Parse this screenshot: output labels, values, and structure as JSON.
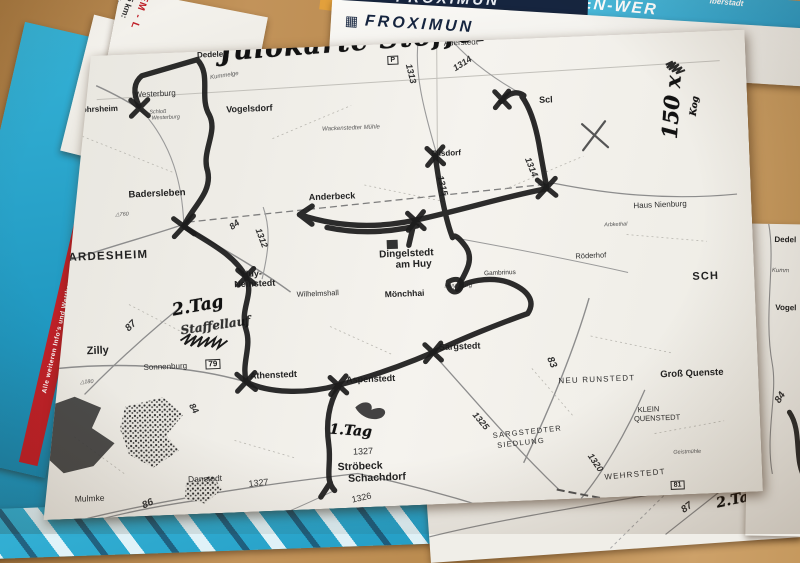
{
  "handwriting": {
    "title": "Julokarte Stoffel",
    "day2": "2.Tag",
    "day2_scribble": "Staffellauf",
    "day1": "1.Tag",
    "copies": "150 x",
    "copies_note": "Kog",
    "day2_bottom": "2.Tag"
  },
  "map": {
    "labels": {
      "dedeleben": "Dedeleb",
      "p_symbol": "P",
      "r78": "78",
      "westerburg": "Westerburg",
      "rohrsheim": "Rohrsheim",
      "schloss1": "Schloß",
      "schloss2": "Westerburg",
      "kummelge": "Kummelge",
      "vogelsdorf": "Vogelsdorf",
      "aderstedt": "Aderstedt",
      "r1313": "1313",
      "r1314a": "1314",
      "scl": "Scl",
      "r1314b": "1314",
      "eilsdorf": "Eilsdorf",
      "r1315": "1315",
      "muehle": "Wackenstedter Mühle",
      "badersleben": "Badersleben",
      "anderbeck": "Anderbeck",
      "hausnienburg": "Haus Nienburg",
      "dardesheim": "DARDESHEIM",
      "r1312": "1312",
      "r84a": "84",
      "dingelstedt1": "Dingelstedt",
      "dingelstedt2": "am Huy",
      "arbkethal": "Arbkethal",
      "roederhof": "Röderhof",
      "sch": "SCH",
      "huy1": "Huy-",
      "huy2": "Neinstedt",
      "wilhelmshall": "Wilhelmshall",
      "moenchhai": "Mönchhai",
      "huysburg": "Huysburg",
      "gambrinus": "Gambrinus",
      "zilly": "Zilly",
      "r87": "87",
      "sonnenburg": "Sonnenburg",
      "r79": "79",
      "p180": "△180",
      "p760": "△760",
      "r84b": "84",
      "athenstedt": "Athenstedt",
      "aspenstedt": "Aspenstedt",
      "sargstedt": "Sargstedt",
      "r83": "83",
      "neurunstedt": "NEU RUNSTEDT",
      "grossquenstedt": "Groß Quenste",
      "r1325": "1325",
      "sargsiedlung1": "SARGSTEDTER",
      "sargsiedlung2": "SIEDLUNG",
      "klein1": "KLEIN",
      "klein2": "QUENSTEDT",
      "r1327a": "1327",
      "stroebeck1": "Ströbeck",
      "stroebeck2": "Schachdorf",
      "r1326": "1326",
      "danstedt": "Danstedt",
      "r1327b": "1327",
      "mulmke": "Mulmke",
      "r86": "86",
      "r1320": "1320",
      "wehrstedt": "WEHRSTEDT",
      "geistmuehle": "Geistmühle",
      "r81": "81"
    }
  },
  "right_sheet": {
    "dedel": "Dedel",
    "kumm": "Kumm",
    "vogel": "Vogel",
    "r84": "84"
  },
  "bottom_sheet": {
    "r87": "87"
  },
  "flyers": {
    "froximun_brand": "FROXIMUN",
    "banner": {
      "corner": "lberstadt",
      "line1": "NINGEN-WER",
      "line2": "vom 31.07.-03.08.201"
    },
    "km_card": {
      "heading": "EM - L",
      "items": [
        "7,5 km:",
        "15 km:",
        "22,5 k"
      ]
    },
    "price_card": {
      "heading": "St",
      "lines": [
        "Einzelstart",
        "Doppelstart 50 €",
        "Alle Läufe 60 €"
      ]
    },
    "teal_stripe_text": "Alle weiteren Info's und Wettkampfunterlagen unter: WWW.LSW-SPEZI",
    "teal_stripe_text_short": "WWW.LSW-SPEZI",
    "bottom_red_text": "St"
  }
}
